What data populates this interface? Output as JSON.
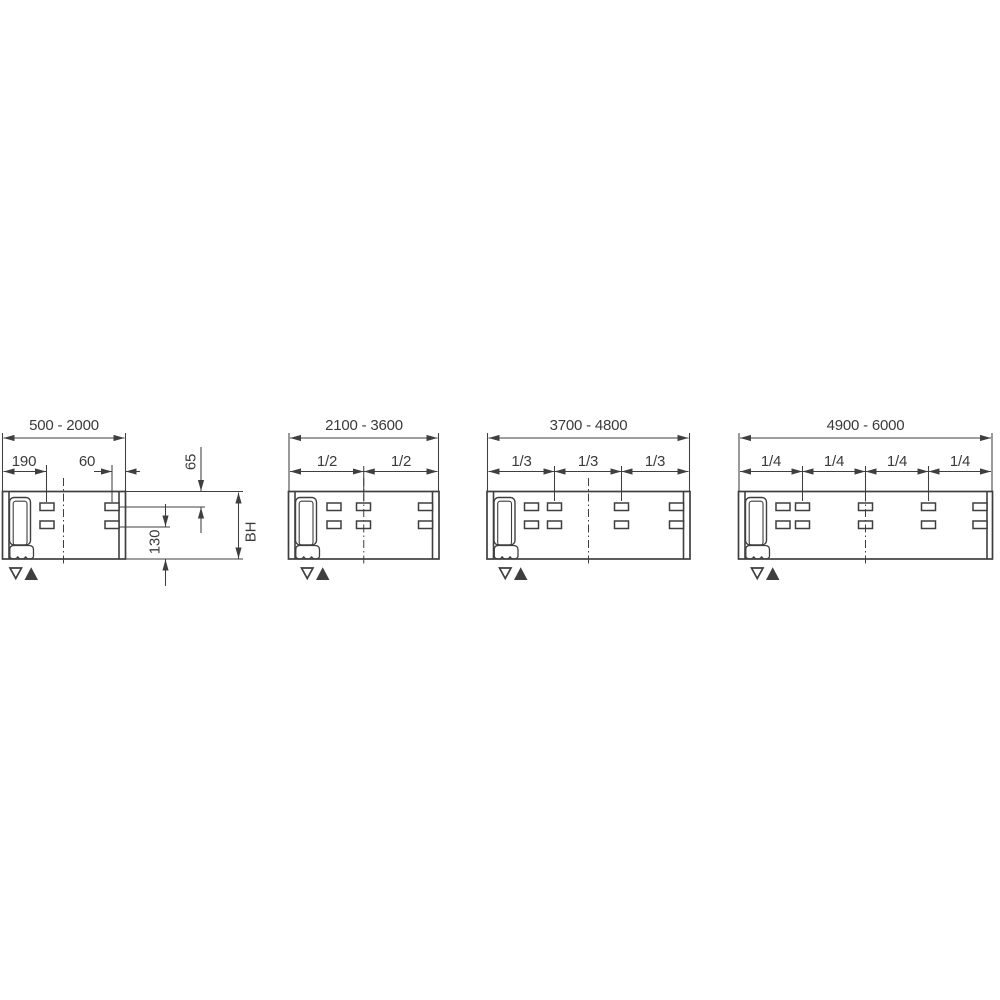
{
  "drawing": {
    "title": "mounting-rail-length-variants",
    "colors": {
      "line": "#3f3f3f",
      "background": "#ffffff"
    },
    "symbols": {
      "triangle_down_icon": "▽",
      "triangle_up_icon": "▲"
    }
  },
  "diagrams": [
    {
      "label": "500 - 2000",
      "left_slot_offset": "190",
      "right_slot_offset": "60",
      "row1_offset": "65",
      "row2_offset": "130",
      "height_label": "BH"
    },
    {
      "label": "2100 - 3600",
      "fractions": [
        "1/2",
        "1/2"
      ]
    },
    {
      "label": "3700 - 4800",
      "fractions": [
        "1/3",
        "1/3",
        "1/3"
      ]
    },
    {
      "label": "4900 - 6000",
      "fractions": [
        "1/4",
        "1/4",
        "1/4",
        "1/4"
      ]
    }
  ]
}
